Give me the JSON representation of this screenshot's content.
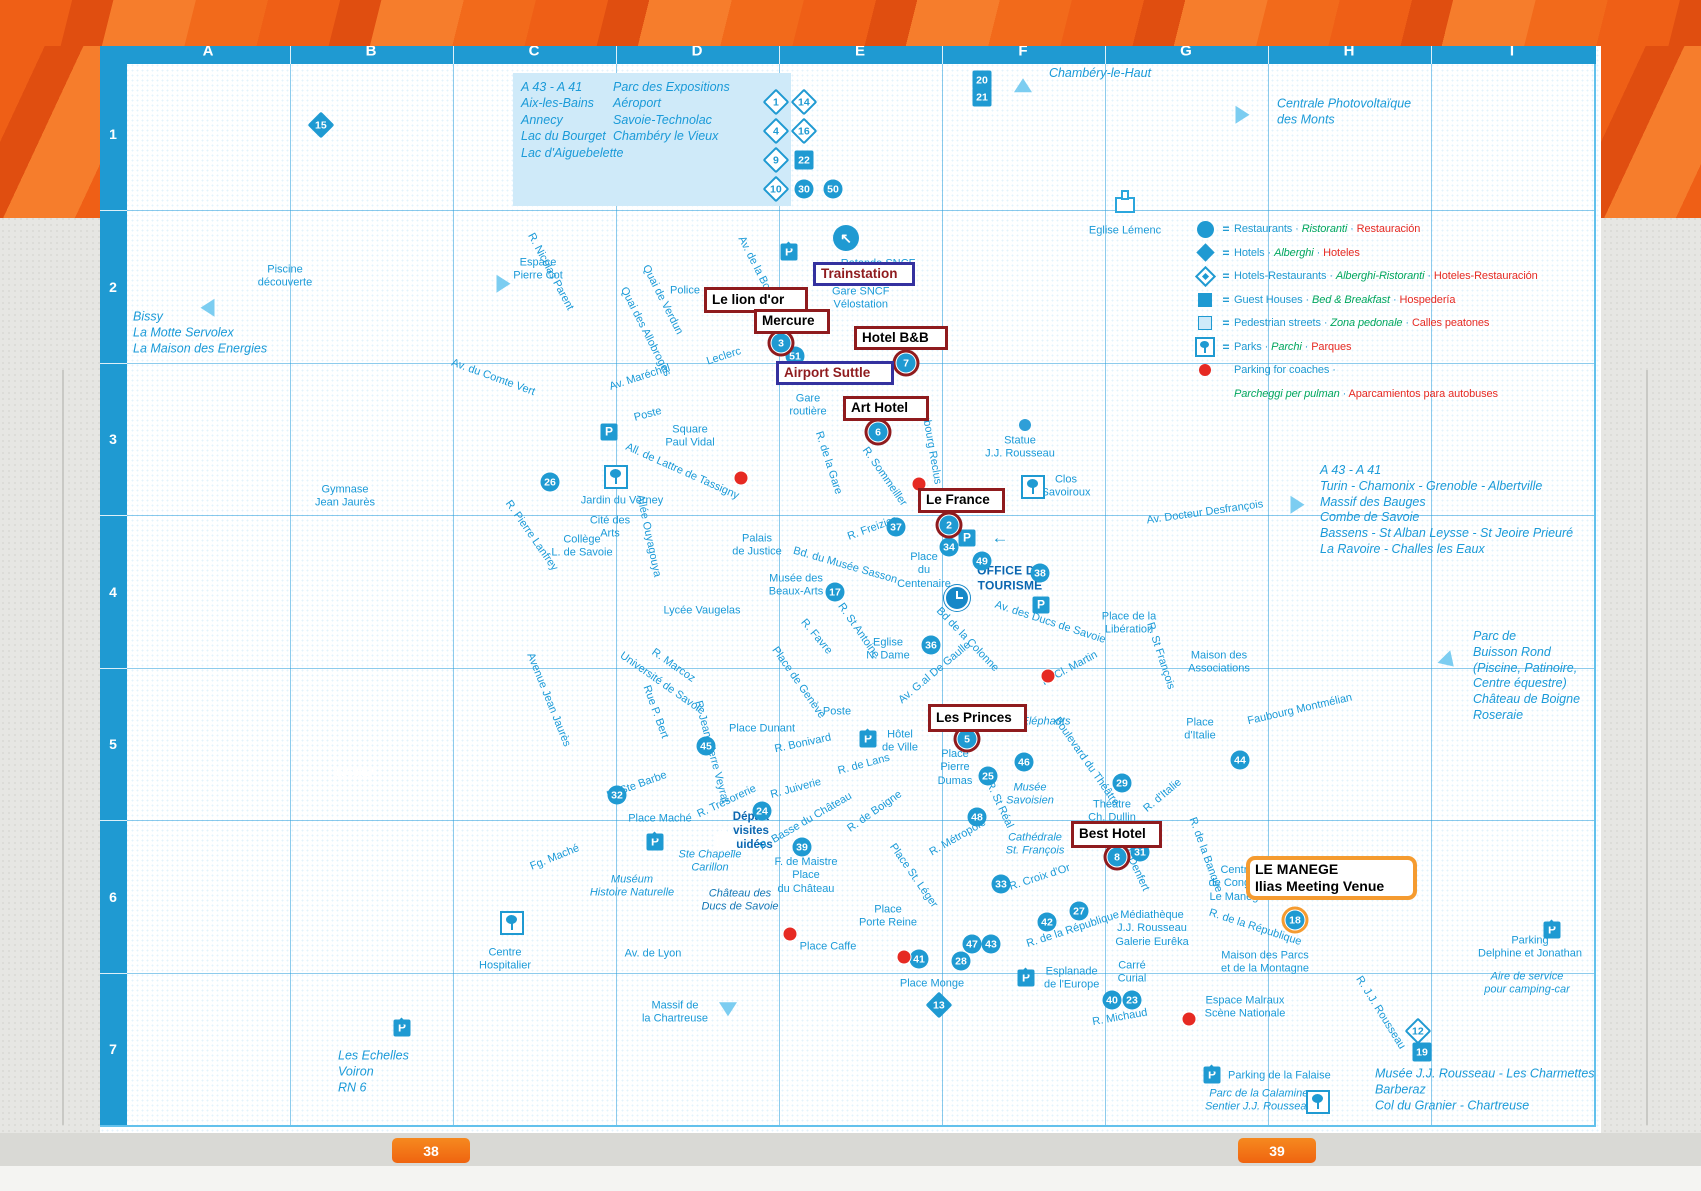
{
  "page": {
    "tabs": [
      {
        "label": "38"
      },
      {
        "label": "39"
      }
    ]
  },
  "grid": {
    "columns": [
      "A",
      "B",
      "C",
      "D",
      "E",
      "F",
      "G",
      "H",
      "I"
    ],
    "rows": [
      "1",
      "2",
      "3",
      "4",
      "5",
      "6",
      "7"
    ],
    "col_x": [
      208,
      371,
      534,
      697,
      860,
      1023,
      1186,
      1349,
      1512
    ],
    "sep_x": [
      290,
      453,
      616,
      779,
      942,
      1105,
      1268,
      1431
    ],
    "row_y": [
      134,
      287,
      439,
      592,
      744,
      897,
      1049
    ],
    "sep_y": [
      210,
      363,
      515,
      668,
      820,
      973
    ]
  },
  "info_box": {
    "left": "A 43 - A 41\nAix-les-Bains\nAnnecy\nLac du Bourget\nLac d'Aiguebelette",
    "right": "Parc des Expositions\nAéroport\nSavoie-Technolac\nChambéry le Vieux"
  },
  "legend": {
    "items": [
      {
        "icon": "circle",
        "eq": "=",
        "en": "Restaurants",
        "it": "Ristoranti",
        "es": "Restauración"
      },
      {
        "icon": "diamond",
        "eq": "=",
        "en": "Hotels",
        "it": "Alberghi",
        "es": "Hoteles"
      },
      {
        "icon": "diamond-o",
        "eq": "=",
        "en": "Hotels-Restaurants",
        "it": "Alberghi-Ristoranti",
        "es": "Hoteles-Restauración"
      },
      {
        "icon": "square",
        "eq": "=",
        "en": "Guest Houses",
        "it": "Bed & Breakfast",
        "es": "Hospedería"
      },
      {
        "icon": "square-l",
        "eq": "=",
        "en": "Pedestrian streets",
        "it": "Zona pedonale",
        "es": "Calles peatones"
      },
      {
        "icon": "park",
        "eq": "=",
        "en": "Parks",
        "it": "Parchi",
        "es": "Parques"
      },
      {
        "icon": "dot-red",
        "eq": "",
        "en": "Parking for coaches ·",
        "it": "",
        "es": ""
      },
      {
        "icon": "",
        "eq": "",
        "en": "",
        "it": "Parcheggi  per pulman",
        "es": "Aparcamientos para autobuses"
      }
    ]
  },
  "annotations": [
    {
      "t": "Trainstation",
      "l": 813,
      "y": 262,
      "w": 102,
      "h": 24,
      "s": "n"
    },
    {
      "t": "Le lion d'or",
      "l": 704,
      "y": 287,
      "w": 104,
      "h": 26,
      "s": "r"
    },
    {
      "t": "Mercure",
      "l": 754,
      "y": 309,
      "w": 76,
      "h": 25,
      "s": "r"
    },
    {
      "t": "Hotel B&B",
      "l": 854,
      "y": 326,
      "w": 94,
      "h": 24,
      "s": "r"
    },
    {
      "t": "Airport Suttle",
      "l": 776,
      "y": 361,
      "w": 118,
      "h": 24,
      "s": "n"
    },
    {
      "t": "Art Hotel",
      "l": 843,
      "y": 396,
      "w": 86,
      "h": 25,
      "s": "r"
    },
    {
      "t": "Le France",
      "l": 918,
      "y": 488,
      "w": 87,
      "h": 25,
      "s": "r"
    },
    {
      "t": "Les Princes",
      "l": 928,
      "y": 704,
      "w": 99,
      "h": 28,
      "s": "r"
    },
    {
      "t": "Best Hotel",
      "l": 1071,
      "y": 821,
      "w": 91,
      "h": 27,
      "s": "r"
    },
    {
      "t": "LE MANEGE\nIlias Meeting Venue",
      "l": 1246,
      "y": 856,
      "w": 171,
      "h": 44,
      "s": "o"
    }
  ],
  "markers": [
    [
      "51",
      795,
      356,
      "c"
    ],
    [
      "26",
      550,
      482,
      "c"
    ],
    [
      "37",
      896,
      527,
      "c"
    ],
    [
      "34",
      949,
      547,
      "c"
    ],
    [
      "17",
      835,
      592,
      "c"
    ],
    [
      "49",
      982,
      561,
      "c"
    ],
    [
      "38",
      1040,
      573,
      "c"
    ],
    [
      "36",
      931,
      645,
      "c"
    ],
    [
      "46",
      1024,
      762,
      "c"
    ],
    [
      "25",
      988,
      776,
      "c"
    ],
    [
      "48",
      977,
      817,
      "c"
    ],
    [
      "29",
      1122,
      783,
      "c"
    ],
    [
      "44",
      1240,
      760,
      "c"
    ],
    [
      "31",
      1140,
      852,
      "c"
    ],
    [
      "33",
      1001,
      884,
      "c"
    ],
    [
      "42",
      1047,
      922,
      "c"
    ],
    [
      "27",
      1079,
      911,
      "c"
    ],
    [
      "47",
      972,
      944,
      "c"
    ],
    [
      "43",
      991,
      944,
      "c"
    ],
    [
      "28",
      961,
      961,
      "c"
    ],
    [
      "41",
      919,
      959,
      "c"
    ],
    [
      "45",
      706,
      746,
      "c"
    ],
    [
      "32",
      617,
      795,
      "c"
    ],
    [
      "24",
      762,
      811,
      "c"
    ],
    [
      "39",
      802,
      847,
      "c"
    ],
    [
      "40",
      1112,
      1000,
      "c"
    ],
    [
      "23",
      1132,
      1000,
      "c"
    ],
    [
      "13",
      939,
      1005,
      "d"
    ],
    [
      "15",
      321,
      125,
      "d"
    ],
    [
      "20",
      982,
      80,
      "sq"
    ],
    [
      "21",
      982,
      97,
      "sq"
    ],
    [
      "12",
      1418,
      1031,
      "do"
    ],
    [
      "19",
      1422,
      1052,
      "sq"
    ],
    [
      "3",
      781,
      343,
      "c",
      "red"
    ],
    [
      "7",
      906,
      363,
      "c",
      "red"
    ],
    [
      "6",
      878,
      432,
      "c",
      "red"
    ],
    [
      "2",
      949,
      525,
      "c",
      "red"
    ],
    [
      "5",
      967,
      739,
      "c",
      "red"
    ],
    [
      "8",
      1117,
      857,
      "c",
      "red"
    ],
    [
      "18",
      1295,
      920,
      "c",
      "org"
    ],
    [
      "1",
      776,
      102,
      "do"
    ],
    [
      "4",
      776,
      131,
      "do"
    ],
    [
      "9",
      776,
      160,
      "do"
    ],
    [
      "10",
      776,
      189,
      "do"
    ],
    [
      "14",
      804,
      102,
      "do"
    ],
    [
      "16",
      804,
      131,
      "do"
    ],
    [
      "22",
      804,
      160,
      "sq"
    ],
    [
      "30",
      804,
      189,
      "c"
    ],
    [
      "50",
      833,
      189,
      "c"
    ]
  ],
  "red_dots": [
    [
      809,
      377
    ],
    [
      919,
      484
    ],
    [
      741,
      478
    ],
    [
      1048,
      676
    ],
    [
      790,
      934
    ],
    [
      904,
      957
    ],
    [
      1189,
      1019
    ]
  ],
  "icons": [
    [
      "p",
      609,
      432
    ],
    [
      "p",
      967,
      538
    ],
    [
      "p",
      1041,
      605
    ],
    [
      "pr",
      789,
      252
    ],
    [
      "pr",
      868,
      739
    ],
    [
      "pr",
      655,
      842
    ],
    [
      "pr",
      1026,
      978
    ],
    [
      "pr",
      402,
      1028
    ],
    [
      "pr",
      1212,
      1075
    ],
    [
      "pr",
      1552,
      930
    ],
    [
      "park",
      616,
      477
    ],
    [
      "park",
      1033,
      487
    ],
    [
      "park",
      1318,
      1102
    ],
    [
      "park",
      512,
      923
    ],
    [
      "church",
      1125,
      205
    ],
    [
      "churchl",
      726,
      842
    ],
    [
      "clock",
      957,
      598
    ],
    [
      "sdot",
      1025,
      425
    ],
    [
      "tri",
      203,
      310,
      -90
    ],
    [
      "tri",
      508,
      286,
      90
    ],
    [
      "tri",
      1023,
      83,
      0
    ],
    [
      "tri",
      1247,
      117,
      90
    ],
    [
      "tri",
      1302,
      507,
      90
    ],
    [
      "tri",
      1452,
      667,
      135
    ],
    [
      "tri",
      728,
      1016,
      180
    ],
    [
      "rot",
      846,
      238,
      "↖"
    ],
    [
      "arrw",
      1000,
      538,
      "←"
    ]
  ],
  "labels": [
    {
      "t": "Piscine\ndécouverte",
      "x": 285,
      "y": 277
    },
    {
      "t": "Bissy\nLa Motte Servolex\nLa Maison des Energies",
      "x": 133,
      "y": 333,
      "c": "bi",
      "a": "l"
    },
    {
      "t": "Espace\nPierre Cot",
      "x": 538,
      "y": 270
    },
    {
      "t": "Police",
      "x": 685,
      "y": 291
    },
    {
      "t": "R. Nicolas Parent",
      "x": 550,
      "y": 272,
      "r": 62
    },
    {
      "t": "Av. du Comte Vert",
      "x": 493,
      "y": 378,
      "r": 20
    },
    {
      "t": "Gymnase\nJean Jaurès",
      "x": 345,
      "y": 497
    },
    {
      "t": "Chambéry-le-Haut",
      "x": 1100,
      "y": 74,
      "c": "bi"
    },
    {
      "t": "Centrale Photovoltaïque\ndes Monts",
      "x": 1277,
      "y": 112,
      "c": "bi",
      "a": "l"
    },
    {
      "t": "Eglise Lémenc",
      "x": 1125,
      "y": 231
    },
    {
      "t": "Rotonde SNCF",
      "x": 878,
      "y": 264
    },
    {
      "t": "Gare SNCF\nVélostation",
      "x": 832,
      "y": 299,
      "a": "l"
    },
    {
      "t": "Gare\nroutière",
      "x": 808,
      "y": 406
    },
    {
      "t": "Quai de Verdun",
      "x": 662,
      "y": 300,
      "r": 63
    },
    {
      "t": "Quai des Allobroges",
      "x": 645,
      "y": 332,
      "r": 63
    },
    {
      "t": "Av. de la Boisse",
      "x": 758,
      "y": 272,
      "r": 63
    },
    {
      "t": "Leclerc",
      "x": 724,
      "y": 357,
      "r": -18
    },
    {
      "t": "Av. Maréchal",
      "x": 640,
      "y": 378,
      "r": -18
    },
    {
      "t": "Poste",
      "x": 648,
      "y": 415,
      "r": -15
    },
    {
      "t": "Square\nPaul Vidal",
      "x": 690,
      "y": 437
    },
    {
      "t": "All. de Lattre de Tassigny",
      "x": 682,
      "y": 472,
      "r": 24
    },
    {
      "t": "Jardin du Verney",
      "x": 622,
      "y": 501
    },
    {
      "t": "Cité des\nArts",
      "x": 610,
      "y": 528
    },
    {
      "t": "Collège\nL. de Savoie",
      "x": 582,
      "y": 547
    },
    {
      "t": "R. Pierre Lanfrey",
      "x": 531,
      "y": 536,
      "r": 55
    },
    {
      "t": "Allée Ouyagouya",
      "x": 648,
      "y": 536,
      "r": 78
    },
    {
      "t": "Palais\nde Justice",
      "x": 757,
      "y": 546
    },
    {
      "t": "Bd. du Musée Sasson",
      "x": 845,
      "y": 566,
      "r": 16
    },
    {
      "t": "Musée des\nBeaux-Arts",
      "x": 796,
      "y": 586
    },
    {
      "t": "R. de la Gare",
      "x": 828,
      "y": 463,
      "r": 72
    },
    {
      "t": "R. Favre",
      "x": 816,
      "y": 637,
      "r": 50
    },
    {
      "t": "Lycée Vaugelas",
      "x": 702,
      "y": 611
    },
    {
      "t": "R. Marcoz",
      "x": 673,
      "y": 666,
      "r": 35
    },
    {
      "t": "Université de Savoie",
      "x": 662,
      "y": 684,
      "r": 35
    },
    {
      "t": "Rue P. Bert",
      "x": 655,
      "y": 712,
      "r": 70
    },
    {
      "t": "Avenue Jean Jaurès",
      "x": 548,
      "y": 700,
      "r": 68
    },
    {
      "t": "R. Jean-Pierre Veyrat",
      "x": 711,
      "y": 752,
      "r": 75
    },
    {
      "t": "Place Dunant",
      "x": 762,
      "y": 729
    },
    {
      "t": "R. Bonivard",
      "x": 803,
      "y": 744,
      "r": -12
    },
    {
      "t": "Place de Genève",
      "x": 798,
      "y": 683,
      "r": 55
    },
    {
      "t": "R. Freizier",
      "x": 872,
      "y": 529,
      "r": -20
    },
    {
      "t": "R. Sommeiller",
      "x": 884,
      "y": 477,
      "r": 55
    },
    {
      "t": "Faubourg Reclus",
      "x": 930,
      "y": 443,
      "r": 80
    },
    {
      "t": "Statue\nJ.J. Rousseau",
      "x": 1020,
      "y": 448
    },
    {
      "t": "Clos\nSavoiroux",
      "x": 1066,
      "y": 487
    },
    {
      "t": "Place\ndu\nCentenaire",
      "x": 924,
      "y": 571
    },
    {
      "t": "OFFICE DE\nTOURISME",
      "x": 1010,
      "y": 578,
      "c": "bd"
    },
    {
      "t": "Av. des Ducs de Savoie",
      "x": 1050,
      "y": 623,
      "r": 18
    },
    {
      "t": "Place de la\nLibération",
      "x": 1129,
      "y": 624
    },
    {
      "t": "Bd de la Colonne",
      "x": 967,
      "y": 640,
      "r": 46
    },
    {
      "t": "Av. G.al De Gaulle",
      "x": 935,
      "y": 673,
      "r": -40
    },
    {
      "t": "R. Cl. Martin",
      "x": 1070,
      "y": 669,
      "r": -28
    },
    {
      "t": "R. St François",
      "x": 1160,
      "y": 656,
      "r": 72
    },
    {
      "t": "R. St Antoine",
      "x": 858,
      "y": 631,
      "r": 55
    },
    {
      "t": "Eglise\nN. Dame",
      "x": 888,
      "y": 650
    },
    {
      "t": "Poste",
      "x": 837,
      "y": 712
    },
    {
      "t": "Hôtel\nde Ville",
      "x": 900,
      "y": 742
    },
    {
      "t": "R. de Lans",
      "x": 864,
      "y": 765,
      "r": -15
    },
    {
      "t": "Place\nPierre\nDumas",
      "x": 955,
      "y": 768
    },
    {
      "t": "Musée\nSavoisien",
      "x": 1030,
      "y": 795,
      "c": "i"
    },
    {
      "t": "Boulevard du Théâtre",
      "x": 1086,
      "y": 762,
      "r": 55
    },
    {
      "t": "R. St Réal",
      "x": 999,
      "y": 805,
      "r": 65
    },
    {
      "t": "R. Métropole",
      "x": 958,
      "y": 838,
      "r": -30
    },
    {
      "t": "Cathédrale\nSt. François",
      "x": 1035,
      "y": 845,
      "c": "i"
    },
    {
      "t": "R. Croix d'Or",
      "x": 1040,
      "y": 878,
      "r": -18
    },
    {
      "t": "Théâtre\nCh. Dullin",
      "x": 1112,
      "y": 812
    },
    {
      "t": "R. Denfert",
      "x": 1135,
      "y": 868,
      "r": 65
    },
    {
      "t": "R. d'Italie",
      "x": 1163,
      "y": 796,
      "r": -40
    },
    {
      "t": "R. de la Banque",
      "x": 1205,
      "y": 855,
      "r": 70
    },
    {
      "t": "Centre\nde Congrès\nLe Manège",
      "x": 1237,
      "y": 884
    },
    {
      "t": "Place\nd'Italie",
      "x": 1200,
      "y": 730
    },
    {
      "t": "Faubourg Montmélian",
      "x": 1300,
      "y": 710,
      "r": -13
    },
    {
      "t": "Maison des\nAssociations",
      "x": 1219,
      "y": 663
    },
    {
      "t": "Av. Docteur Desfrançois",
      "x": 1205,
      "y": 513,
      "r": -8
    },
    {
      "t": "A 43 - A 41\nTurin - Chamonix - Grenoble - Albertville\nMassif des Bauges\nCombe de Savoie\nBassens - St Alban Leysse - St Jeoire Prieuré\nLa Ravoire - Challes les Eaux",
      "x": 1320,
      "y": 510,
      "c": "bi",
      "a": "l"
    },
    {
      "t": "Parc de\nBuisson Rond\n(Piscine, Patinoire,\nCentre équestre)\nChâteau de Boigne\nRoseraie",
      "x": 1473,
      "y": 676,
      "c": "bi",
      "a": "l"
    },
    {
      "t": "R. de la République",
      "x": 1073,
      "y": 930,
      "r": -18
    },
    {
      "t": "R. de la République",
      "x": 1255,
      "y": 928,
      "r": 18
    },
    {
      "t": "Médiathèque\nJ.J. Rousseau\nGalerie Eurêka",
      "x": 1152,
      "y": 929
    },
    {
      "t": "Maison des Parcs\net de la Montagne",
      "x": 1265,
      "y": 963
    },
    {
      "t": "Carré\nCurial",
      "x": 1132,
      "y": 973
    },
    {
      "t": "R. Michaud",
      "x": 1120,
      "y": 1018,
      "r": -10
    },
    {
      "t": "Espace Malraux\nScène Nationale",
      "x": 1245,
      "y": 1008
    },
    {
      "t": "R. J.J. Rousseau",
      "x": 1380,
      "y": 1013,
      "r": 58
    },
    {
      "t": "Musée J.J. Rousseau - Les Charmettes\nBarberaz\nCol du Granier - Chartreuse",
      "x": 1375,
      "y": 1090,
      "c": "bi",
      "a": "l"
    },
    {
      "t": "Parking de la Falaise",
      "x": 1228,
      "y": 1076,
      "a": "l"
    },
    {
      "t": "Parc de la Calamine\nSentier J.J. Rousseau",
      "x": 1205,
      "y": 1101,
      "c": "i",
      "a": "l"
    },
    {
      "t": "Parking\nDelphine et Jonathan",
      "x": 1530,
      "y": 948
    },
    {
      "t": "Aire de service\npour camping-car",
      "x": 1527,
      "y": 984,
      "c": "i"
    },
    {
      "t": "Massif de\nla Chartreuse",
      "x": 675,
      "y": 1013
    },
    {
      "t": "Les Echelles\nVoiron\nRN 6",
      "x": 338,
      "y": 1072,
      "c": "bi",
      "a": "l"
    },
    {
      "t": "Centre\nHospitalier",
      "x": 505,
      "y": 960
    },
    {
      "t": "Av. de Lyon",
      "x": 653,
      "y": 954
    },
    {
      "t": "Fg. Maché",
      "x": 555,
      "y": 858,
      "r": -22
    },
    {
      "t": "Place Maché",
      "x": 660,
      "y": 819
    },
    {
      "t": "R. Ste Barbe",
      "x": 637,
      "y": 786,
      "r": -20
    },
    {
      "t": "R. Trésorerie",
      "x": 727,
      "y": 802,
      "r": -25
    },
    {
      "t": "R. Juiverie",
      "x": 796,
      "y": 789,
      "r": -15
    },
    {
      "t": "Départ\nvisites\nguidées",
      "x": 751,
      "y": 831,
      "c": "bds"
    },
    {
      "t": "R. Basse du Château",
      "x": 806,
      "y": 822,
      "r": -30
    },
    {
      "t": "Ste Chapelle\nCarillon",
      "x": 710,
      "y": 862,
      "c": "i"
    },
    {
      "t": "Château des\nDucs de Savoie",
      "x": 740,
      "y": 901,
      "c": "i dk"
    },
    {
      "t": "Muséum\nHistoire Naturelle",
      "x": 632,
      "y": 887,
      "c": "i"
    },
    {
      "t": "F. de Maistre\nPlace\ndu Château",
      "x": 806,
      "y": 876
    },
    {
      "t": "Place Caffe",
      "x": 828,
      "y": 947
    },
    {
      "t": "Place\nPorte Reine",
      "x": 888,
      "y": 917
    },
    {
      "t": "Place St. Léger",
      "x": 913,
      "y": 876,
      "r": 55
    },
    {
      "t": "Place Monge",
      "x": 932,
      "y": 984
    },
    {
      "t": "Esplanade\nde l'Europe",
      "x": 1044,
      "y": 979,
      "a": "l"
    },
    {
      "t": "R. de Boigne",
      "x": 875,
      "y": 812,
      "r": -35
    },
    {
      "t": "Eléphants",
      "x": 1046,
      "y": 722,
      "c": "i"
    },
    {
      "t": "NORD",
      "x": 355,
      "y": 772,
      "c": "nord"
    }
  ],
  "colors": {
    "accent_blue": "#1f9ad2",
    "label_blue": "#1a9ad8",
    "dark_label": "#0a66b0",
    "block_light": "#abdcf5",
    "block_dark": "#69c5ee",
    "legend_green": "#00a65e",
    "legend_red": "#e62a23",
    "annotation_maroon": "#8f1b1e",
    "annotation_navy": "#34319f",
    "annotation_orange": "#f59b30",
    "band_orange": "#f26a1b",
    "station_red": "#8e2037"
  }
}
